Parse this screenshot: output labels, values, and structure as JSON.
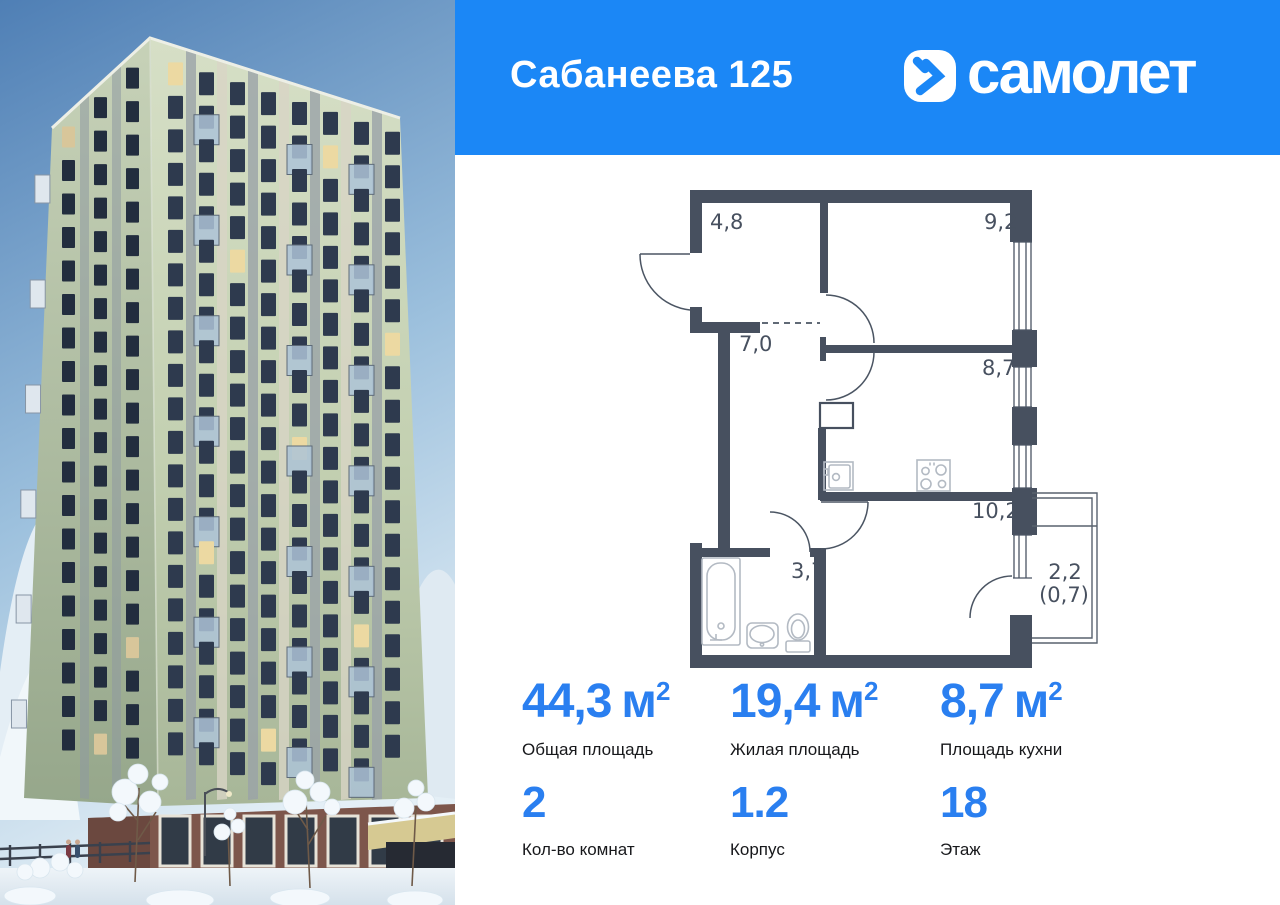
{
  "header": {
    "title": "Сабанеева 125",
    "brand": "самолет"
  },
  "floor_plan": {
    "rooms": [
      {
        "name": "hallway",
        "area": "4,8"
      },
      {
        "name": "room",
        "area": "9,2"
      },
      {
        "name": "corridor",
        "area": "7,0"
      },
      {
        "name": "kitchen",
        "area": "8,7"
      },
      {
        "name": "living-room",
        "area": "10,2"
      },
      {
        "name": "bathroom",
        "area": "3,7"
      },
      {
        "name": "balcony",
        "area": "2,2",
        "area_coefficient": "(0,7)"
      }
    ]
  },
  "stats": {
    "row1": [
      {
        "value": "44,3",
        "unit": "м",
        "sup": "2",
        "label": "Общая площадь"
      },
      {
        "value": "19,4",
        "unit": "м",
        "sup": "2",
        "label": "Жилая площадь"
      },
      {
        "value": "8,7",
        "unit": "м",
        "sup": "2",
        "label": "Площадь кухни"
      }
    ],
    "row2": [
      {
        "value": "2",
        "label": "Кол-во комнат"
      },
      {
        "value": "1.2",
        "label": "Корпус"
      },
      {
        "value": "18",
        "label": "Этаж"
      }
    ]
  },
  "colors": {
    "header_blue": "#1b87f6",
    "accent_blue": "#2a7ff0",
    "wall": "#47505f"
  }
}
